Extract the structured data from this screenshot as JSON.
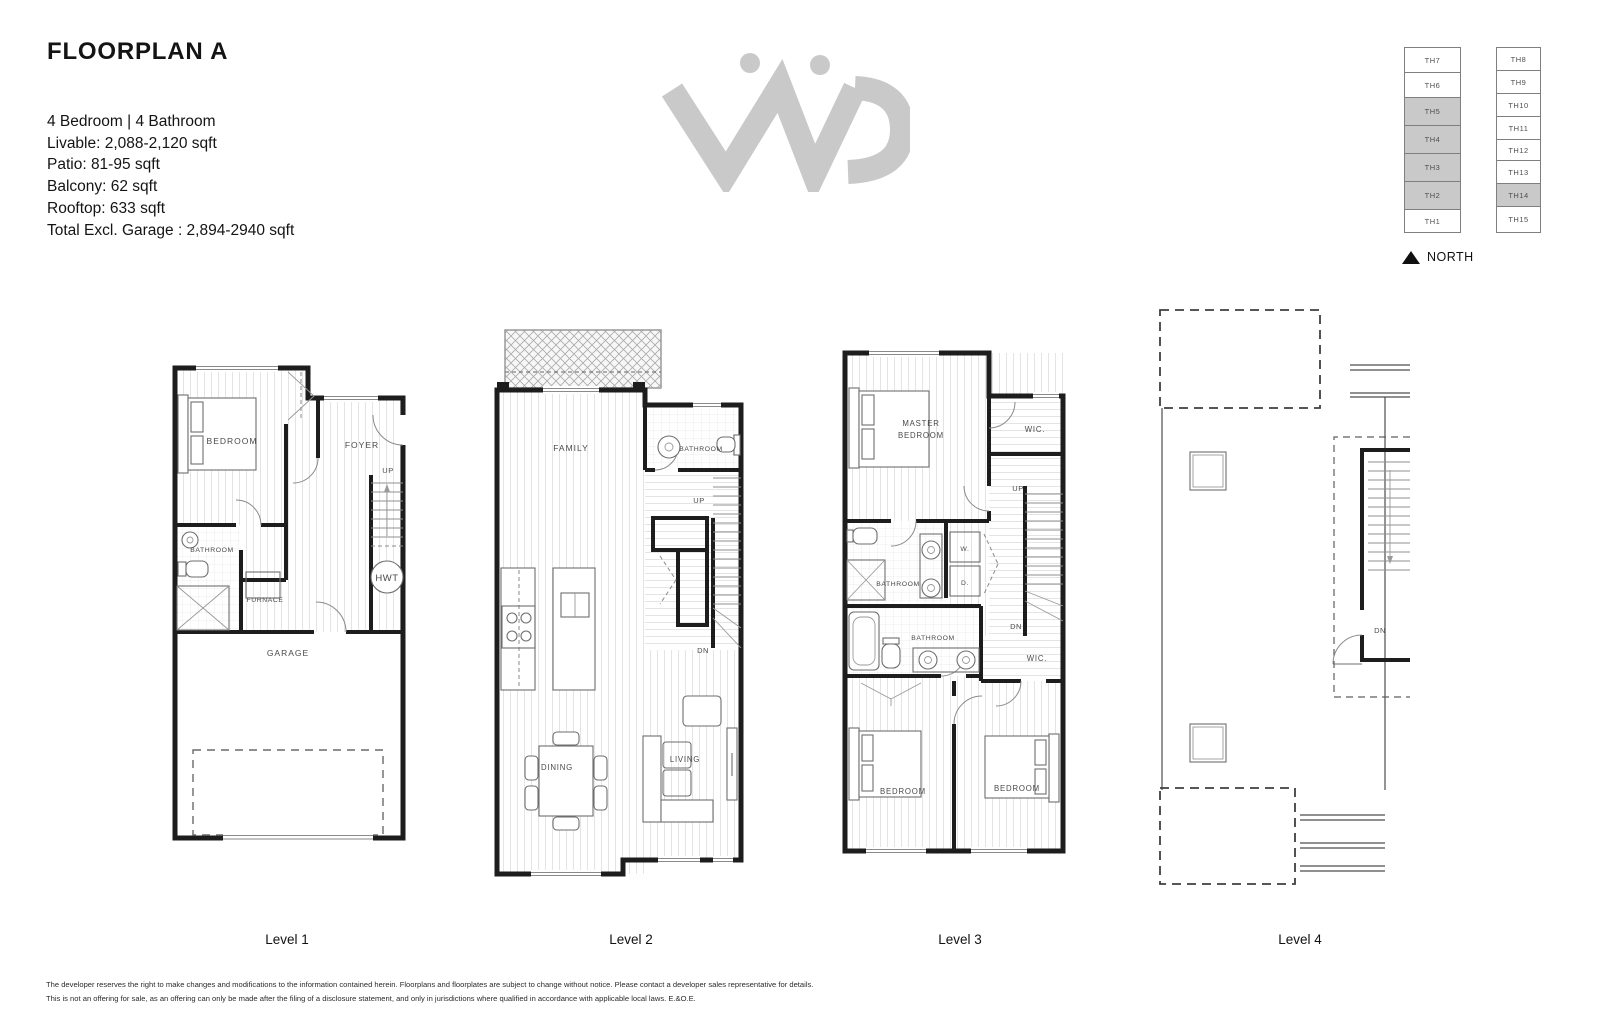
{
  "header": {
    "title": "FLOORPLAN A",
    "specs": [
      "4 Bedroom | 4 Bathroom",
      "Livable: 2,088-2,120 sqft",
      "Patio: 81-95 sqft",
      "Balcony: 62 sqft",
      "Rooftop: 633 sqft",
      "Total Excl. Garage : 2,894-2940 sqft"
    ]
  },
  "site_plan": {
    "north_label": "NORTH",
    "west_building": [
      {
        "label": "TH7",
        "cls": "site-unit"
      },
      {
        "label": "TH6",
        "cls": "site-unit"
      },
      {
        "label": "TH5",
        "cls": "site-unit shaded"
      },
      {
        "label": "TH4",
        "cls": "site-unit shaded"
      },
      {
        "label": "TH3",
        "cls": "site-unit shaded"
      },
      {
        "label": "TH2",
        "cls": "site-unit shaded"
      },
      {
        "label": "TH1",
        "cls": "site-unit"
      }
    ],
    "east_building": [
      {
        "label": "TH8",
        "cls": "site-unit"
      },
      {
        "label": "TH9",
        "cls": "site-unit"
      },
      {
        "label": "TH10",
        "cls": "site-unit"
      },
      {
        "label": "TH11",
        "cls": "site-unit"
      },
      {
        "label": "TH12",
        "cls": "site-unit"
      },
      {
        "label": "TH13",
        "cls": "site-unit"
      },
      {
        "label": "TH14",
        "cls": "site-unit shaded"
      },
      {
        "label": "TH15",
        "cls": "site-unit"
      }
    ]
  },
  "levels": {
    "level1": {
      "caption": "Level 1",
      "labels": {
        "bedroom": "BEDROOM",
        "foyer": "FOYER",
        "up": "UP",
        "bathroom": "BATHROOM",
        "furnace": "FURNACE",
        "hwt": "HWT",
        "garage": "GARAGE"
      }
    },
    "level2": {
      "caption": "Level 2",
      "labels": {
        "family": "FAMILY",
        "bathroom": "BATHROOM",
        "up": "UP",
        "dn": "DN",
        "dining": "DINING",
        "living": "LIVING"
      }
    },
    "level3": {
      "caption": "Level 3",
      "labels": {
        "master_line1": "MASTER",
        "master_line2": "BEDROOM",
        "wic_top": "WIC.",
        "up": "UP",
        "bathroom_ensuite": "BATHROOM",
        "washer": "W.",
        "dryer": "D.",
        "bathroom_main": "BATHROOM",
        "dn": "DN",
        "wic_lower": "WIC.",
        "bedroom_left": "BEDROOM",
        "bedroom_right": "BEDROOM"
      }
    },
    "level4": {
      "caption": "Level 4",
      "labels": {
        "dn": "DN"
      }
    }
  },
  "footer": {
    "disclaimer": [
      "The developer reserves the right to make changes and modifications to the information contained herein. Floorplans and floorplates are subject to change without notice. Please contact a developer sales representative for details.",
      "This is not an offering for sale, as an offering can only be made after the filing of a disclosure statement, and only in jurisdictions where qualified in accordance with applicable local laws. E.&O.E."
    ]
  },
  "colors": {
    "wall": "#1d1d1d",
    "shaded_unit": "#c9c9c9",
    "logo": "#c9c9c9",
    "floor_line": "#e4e4e4"
  }
}
